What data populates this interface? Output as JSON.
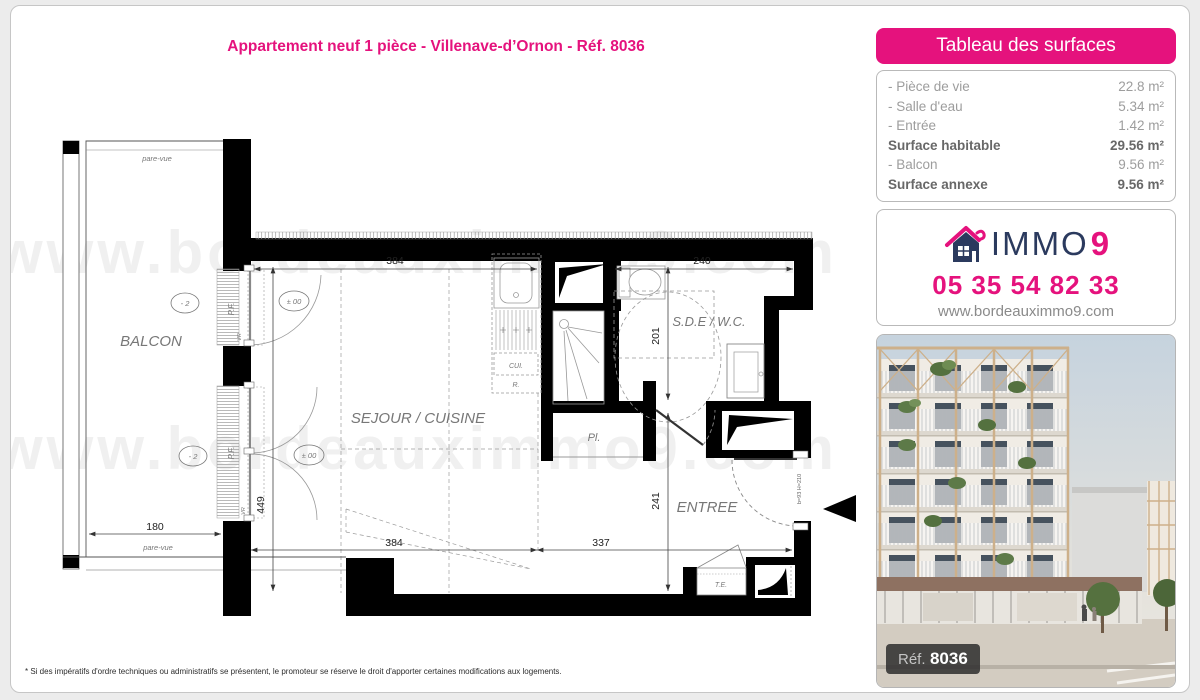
{
  "page": {
    "title": "Appartement neuf 1 pièce - Villenave-d’Ornon - Réf. 8036",
    "watermark": "www.bordeauximmo9.com",
    "footnote": "* Si des impératifs d'ordre techniques ou administratifs se présentent, le promoteur se réserve le droit d'apporter certaines modifications aux logements."
  },
  "surfaces": {
    "header": "Tableau des surfaces",
    "rows": [
      {
        "label": "- Pièce de vie",
        "value": "22.8 m²"
      },
      {
        "label": "- Salle d'eau",
        "value": "5.34 m²"
      },
      {
        "label": "- Entrée",
        "value": "1.42 m²"
      },
      {
        "label": "Surface habitable",
        "value": "29.56 m²"
      },
      {
        "label": "- Balcon",
        "value": "9.56 m²"
      },
      {
        "label": "Surface annexe",
        "value": "9.56 m²"
      }
    ]
  },
  "agency": {
    "brand": "IMMO",
    "brand_number": "9",
    "phone": "05 35 54 82 33",
    "website": "www.bordeauximmo9.com"
  },
  "photo": {
    "ref_label": "Réf.",
    "ref_number": "8036"
  },
  "plan": {
    "labels": {
      "balcon": "BALCON",
      "sejour": "SEJOUR / CUISINE",
      "sde": "S.D.E / W.C.",
      "entree": "ENTREE",
      "placard": "Pl.",
      "te": "T.E.",
      "cui": "CUI.",
      "r": "R.",
      "pf": "P.F.",
      "vr": "VR",
      "pare_vue": "pare-vue",
      "level_minus2": "- 2",
      "level_zero": "± 00",
      "door_spec": "b=93 H=210"
    },
    "dims": {
      "sejour_width": "384",
      "sde_width": "240",
      "sde_depth": "201",
      "entree_depth": "241",
      "sejour_depth": "449",
      "entree_width": "337",
      "balcon_width": "180"
    }
  },
  "colors": {
    "accent": "#e5127d",
    "navy": "#2b3a5e",
    "wall": "#000000"
  }
}
